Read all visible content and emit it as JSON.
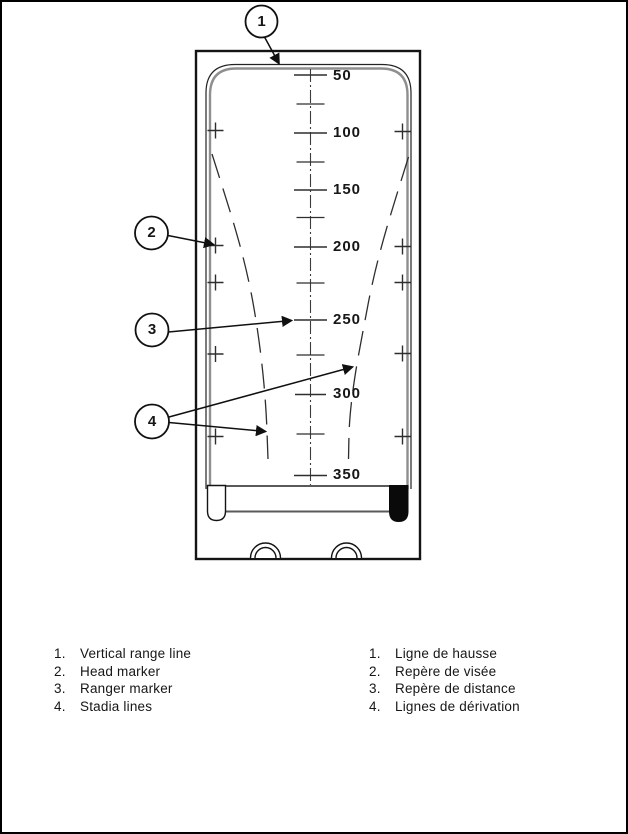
{
  "figure": {
    "scale_labels": [
      "50",
      "100",
      "150",
      "200",
      "250",
      "300",
      "350"
    ],
    "callouts": [
      "1",
      "2",
      "3",
      "4"
    ]
  },
  "legend_en": [
    {
      "num": "1.",
      "label": "Vertical range line"
    },
    {
      "num": "2.",
      "label": "Head marker"
    },
    {
      "num": "3.",
      "label": "Ranger marker"
    },
    {
      "num": "4.",
      "label": "Stadia lines"
    }
  ],
  "legend_fr": [
    {
      "num": "1.",
      "label": "Ligne de hausse"
    },
    {
      "num": "2.",
      "label": "Repère de visée"
    },
    {
      "num": "3.",
      "label": "Repère de distance"
    },
    {
      "num": "4.",
      "label": "Lignes de dérivation"
    }
  ]
}
